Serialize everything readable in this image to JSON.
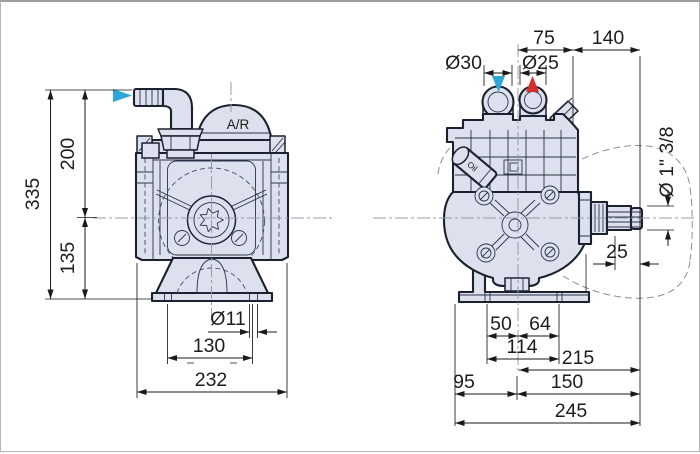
{
  "drawing": {
    "front_view": {
      "air_chamber_label": "A/R",
      "dims": {
        "overall_height": "335",
        "inlet_height": "200",
        "axis_height": "135",
        "foot_hole_dia": "Ø11",
        "foot_slot_span": "130",
        "overall_width": "232"
      }
    },
    "side_view": {
      "oil_label": "Oil",
      "dims": {
        "center_to_edge": "75",
        "edge_to_shaft_end": "140",
        "suction_dia": "Ø30",
        "delivery_dia": "Ø25",
        "shaft_spec": "Ø 1\" 3/8",
        "spline_length": "25",
        "foot_left": "50",
        "foot_right": "64",
        "foot_span": "114",
        "center_to_shaft_end_upper": "215",
        "left_overhang": "95",
        "center_to_shaft_end": "150",
        "overall_length": "245"
      }
    },
    "colors": {
      "suction_arrow": "#2ea7d8",
      "delivery_arrow": "#d2302c",
      "body_fill": "#dde1ee",
      "outline": "#1c2130"
    }
  }
}
